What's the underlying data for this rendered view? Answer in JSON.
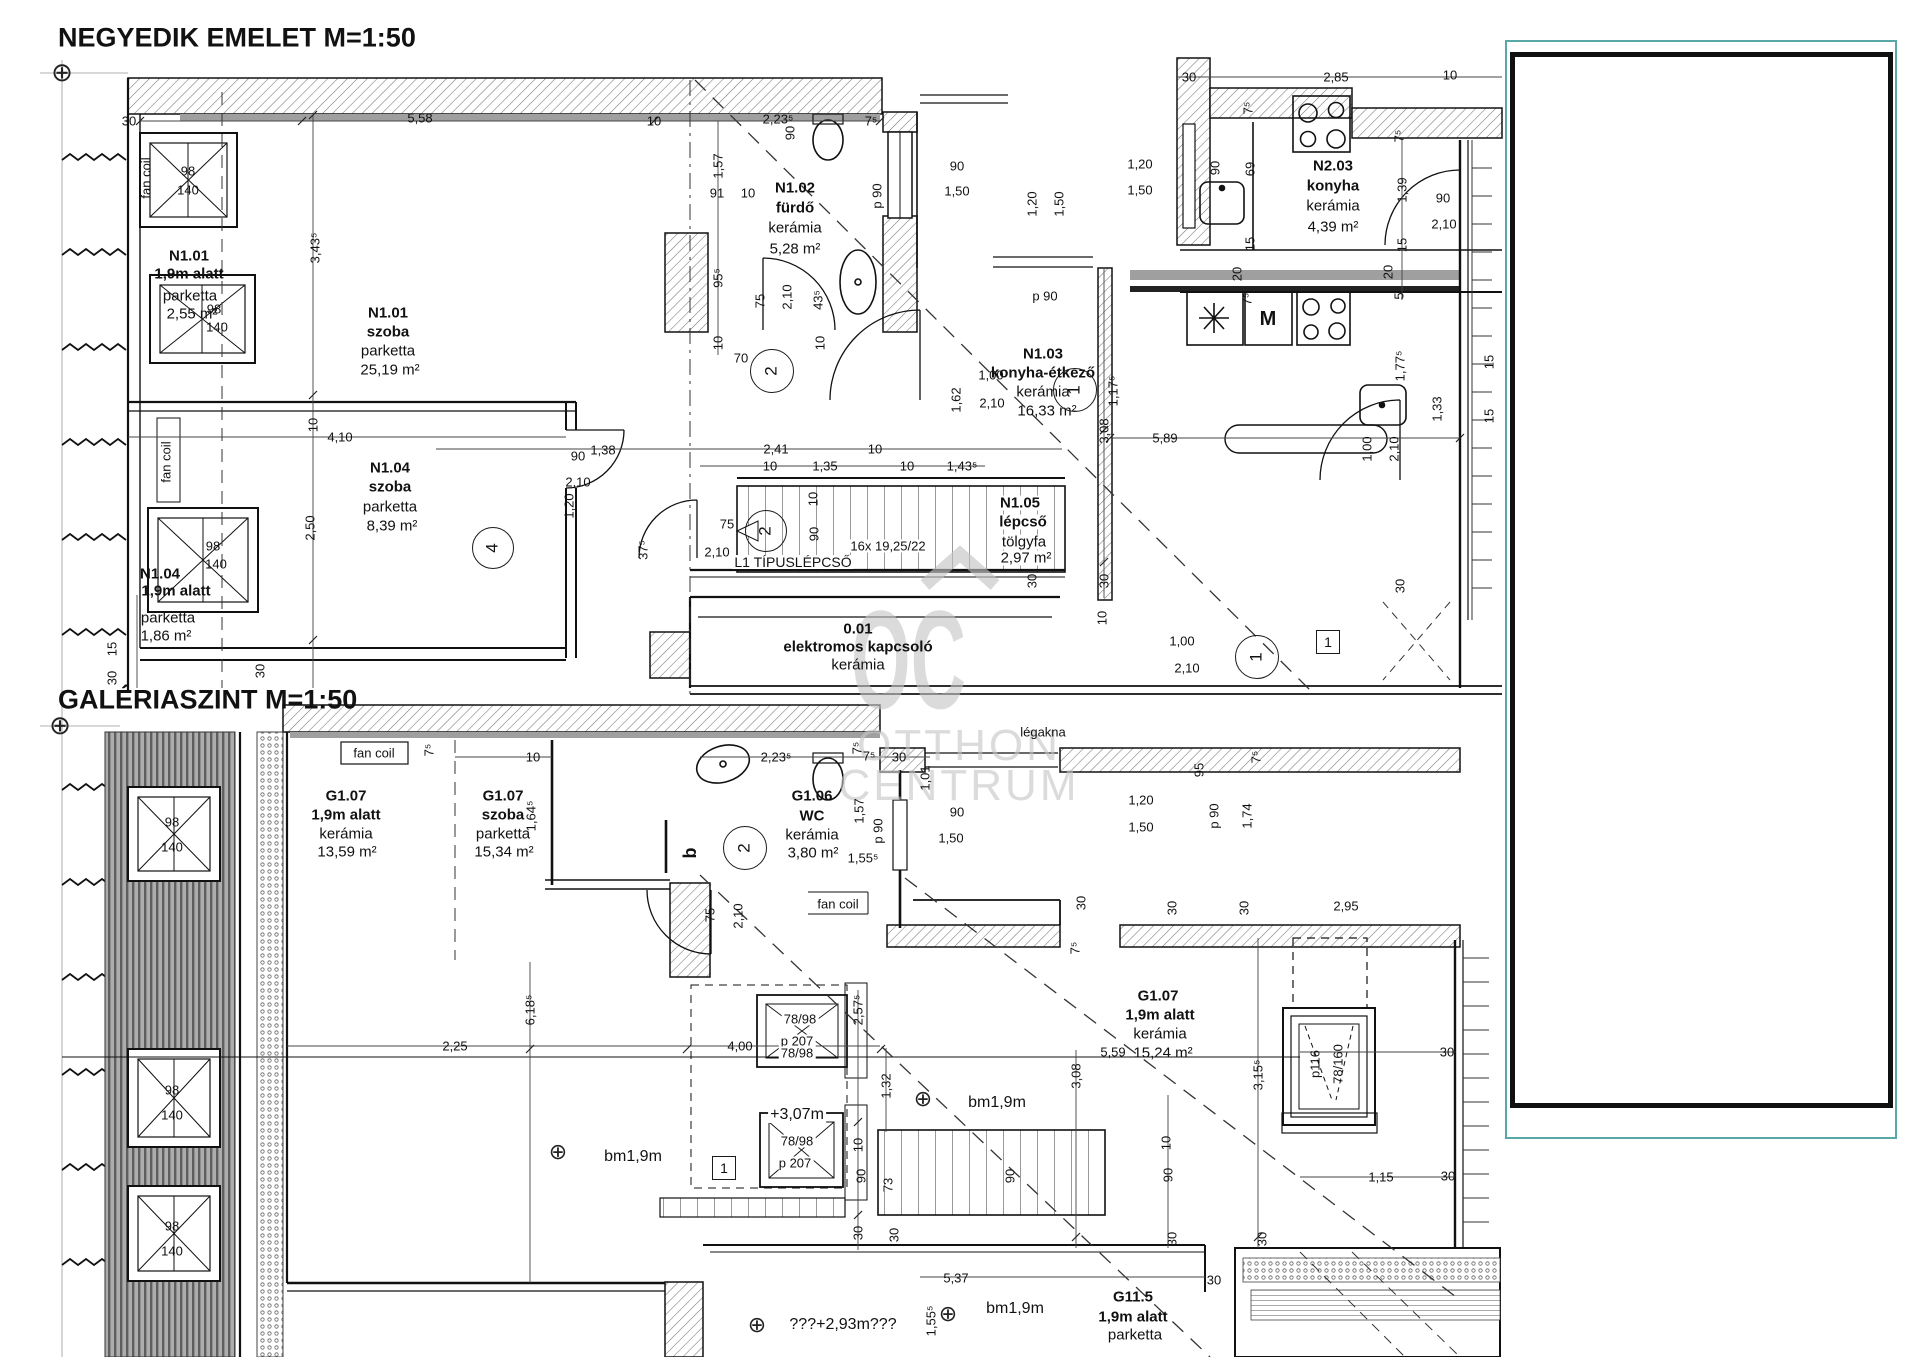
{
  "page": {
    "width": 1920,
    "height": 1357,
    "background": "#ffffff"
  },
  "colors": {
    "line": "#111111",
    "dim": "#444444",
    "watermark": "#c8c8c8",
    "panel_border_teal": "#58a8a8",
    "panel_border_black": "#101010",
    "roof_band": "#adadad"
  },
  "watermark": {
    "mark": "OC",
    "line1": "OTTHON",
    "line2": "CENTRUM"
  },
  "titles": {
    "upper": "NEGYEDIK EMELET M=1:50",
    "lower": "GALÉRIASZINT M=1:50"
  },
  "labels": [
    {
      "t": "NEGYEDIK EMELET M=1:50",
      "x": 58,
      "y": 38,
      "s": 27,
      "b": 1,
      "a": "l"
    },
    {
      "t": "GALÉRIASZINT M=1:50",
      "x": 58,
      "y": 700,
      "s": 27,
      "b": 1,
      "a": "l"
    },
    {
      "t": "30",
      "x": 129,
      "y": 121
    },
    {
      "t": "5,58",
      "x": 420,
      "y": 118
    },
    {
      "t": "10",
      "x": 654,
      "y": 121
    },
    {
      "t": "2,23⁵",
      "x": 778,
      "y": 119
    },
    {
      "t": "90",
      "x": 790,
      "y": 133,
      "r": 1
    },
    {
      "t": "7⁵",
      "x": 871,
      "y": 121
    },
    {
      "t": "1,57",
      "x": 718,
      "y": 166,
      "r": 1
    },
    {
      "t": "91",
      "x": 717,
      "y": 193
    },
    {
      "t": "10",
      "x": 748,
      "y": 193
    },
    {
      "t": "95⁵",
      "x": 718,
      "y": 278,
      "r": 1
    },
    {
      "t": "75",
      "x": 760,
      "y": 301,
      "r": 1
    },
    {
      "t": "2,10",
      "x": 787,
      "y": 297,
      "r": 1
    },
    {
      "t": "43⁵",
      "x": 818,
      "y": 300,
      "r": 1
    },
    {
      "t": "10",
      "x": 718,
      "y": 343,
      "r": 1
    },
    {
      "t": "10",
      "x": 820,
      "y": 343,
      "r": 1
    },
    {
      "t": "70",
      "x": 741,
      "y": 358
    },
    {
      "t": "p 90",
      "x": 877,
      "y": 196,
      "r": 1
    },
    {
      "t": "90",
      "x": 957,
      "y": 166
    },
    {
      "t": "1,50",
      "x": 957,
      "y": 191
    },
    {
      "t": "1,20",
      "x": 1140,
      "y": 164
    },
    {
      "t": "1,50",
      "x": 1140,
      "y": 190
    },
    {
      "t": "1,20",
      "x": 1032,
      "y": 204,
      "r": 1
    },
    {
      "t": "1,50",
      "x": 1059,
      "y": 204,
      "r": 1
    },
    {
      "t": "30",
      "x": 1189,
      "y": 77
    },
    {
      "t": "2,85",
      "x": 1336,
      "y": 77
    },
    {
      "t": "10",
      "x": 1450,
      "y": 75
    },
    {
      "t": "7⁵",
      "x": 1248,
      "y": 108,
      "r": 1
    },
    {
      "t": "7⁵",
      "x": 1399,
      "y": 136,
      "r": 1
    },
    {
      "t": "90",
      "x": 1215,
      "y": 168,
      "r": 1
    },
    {
      "t": "69",
      "x": 1250,
      "y": 169,
      "r": 1
    },
    {
      "t": "1,39",
      "x": 1402,
      "y": 190,
      "r": 1
    },
    {
      "t": "90",
      "x": 1443,
      "y": 198
    },
    {
      "t": "2,10",
      "x": 1444,
      "y": 224
    },
    {
      "t": "15",
      "x": 1250,
      "y": 244,
      "r": 1
    },
    {
      "t": "15",
      "x": 1402,
      "y": 245,
      "r": 1
    },
    {
      "t": "20",
      "x": 1237,
      "y": 274,
      "r": 1
    },
    {
      "t": "20",
      "x": 1388,
      "y": 272,
      "r": 1
    },
    {
      "t": "7⁵",
      "x": 1247,
      "y": 299,
      "r": 1
    },
    {
      "t": "5",
      "x": 1399,
      "y": 296,
      "r": 1
    },
    {
      "t": "M",
      "x": 1268,
      "y": 319,
      "b": 1,
      "s": 20
    },
    {
      "t": "1,77⁵",
      "x": 1400,
      "y": 366,
      "r": 1
    },
    {
      "t": "p 90",
      "x": 1045,
      "y": 296
    },
    {
      "t": "1,17⁵",
      "x": 1113,
      "y": 391,
      "r": 1
    },
    {
      "t": "1,00",
      "x": 991,
      "y": 375
    },
    {
      "t": "2,10",
      "x": 992,
      "y": 403
    },
    {
      "t": "1,62",
      "x": 956,
      "y": 400,
      "r": 1
    },
    {
      "t": "1,38",
      "x": 603,
      "y": 450
    },
    {
      "t": "2,41",
      "x": 776,
      "y": 449
    },
    {
      "t": "10",
      "x": 875,
      "y": 449
    },
    {
      "t": "10",
      "x": 770,
      "y": 466
    },
    {
      "t": "1,35",
      "x": 825,
      "y": 466
    },
    {
      "t": "10",
      "x": 907,
      "y": 466
    },
    {
      "t": "1,43⁵",
      "x": 962,
      "y": 466
    },
    {
      "t": "3,08",
      "x": 1104,
      "y": 431,
      "r": 1
    },
    {
      "t": "5,89",
      "x": 1165,
      "y": 438
    },
    {
      "t": "30",
      "x": 1104,
      "y": 581,
      "r": 1
    },
    {
      "t": "30",
      "x": 1032,
      "y": 581,
      "r": 1
    },
    {
      "t": "30",
      "x": 1400,
      "y": 586,
      "r": 1
    },
    {
      "t": "10",
      "x": 1102,
      "y": 618,
      "r": 1
    },
    {
      "t": "4,10",
      "x": 340,
      "y": 437
    },
    {
      "t": "10",
      "x": 313,
      "y": 425,
      "r": 1
    },
    {
      "t": "3,43⁵",
      "x": 315,
      "y": 248,
      "r": 1
    },
    {
      "t": "2,50",
      "x": 310,
      "y": 528,
      "r": 1
    },
    {
      "t": "15",
      "x": 112,
      "y": 649,
      "r": 1
    },
    {
      "t": "30",
      "x": 112,
      "y": 678,
      "r": 1
    },
    {
      "t": "30",
      "x": 260,
      "y": 671,
      "r": 1
    },
    {
      "t": "98",
      "x": 188,
      "y": 171
    },
    {
      "t": "140",
      "x": 188,
      "y": 190
    },
    {
      "t": "98",
      "x": 214,
      "y": 309
    },
    {
      "t": "140",
      "x": 217,
      "y": 327
    },
    {
      "t": "98",
      "x": 213,
      "y": 546
    },
    {
      "t": "140",
      "x": 216,
      "y": 564
    },
    {
      "t": "90",
      "x": 578,
      "y": 456
    },
    {
      "t": "2,10",
      "x": 578,
      "y": 482
    },
    {
      "t": "1,20",
      "x": 569,
      "y": 506,
      "r": 1
    },
    {
      "t": "75",
      "x": 727,
      "y": 524
    },
    {
      "t": "2,10",
      "x": 717,
      "y": 552
    },
    {
      "t": "37⁵",
      "x": 643,
      "y": 550,
      "r": 1
    },
    {
      "t": "10",
      "x": 813,
      "y": 499,
      "r": 1
    },
    {
      "t": "90",
      "x": 814,
      "y": 534,
      "r": 1
    },
    {
      "t": "16x 19,25/22",
      "x": 888,
      "y": 546,
      "bg": 1
    },
    {
      "t": "L1 TÍPUSLÉPCSŐ",
      "x": 793,
      "y": 562,
      "s": 14,
      "bg": 1
    },
    {
      "t": "1,00",
      "x": 1182,
      "y": 641
    },
    {
      "t": "2,10",
      "x": 1187,
      "y": 668
    },
    {
      "t": "1,00",
      "x": 1367,
      "y": 449,
      "r": 1
    },
    {
      "t": "2,10",
      "x": 1394,
      "y": 449,
      "r": 1
    },
    {
      "t": "1,33",
      "x": 1437,
      "y": 409,
      "r": 1
    },
    {
      "t": "15",
      "x": 1489,
      "y": 362,
      "r": 1
    },
    {
      "t": "15",
      "x": 1489,
      "y": 416,
      "r": 1
    },
    {
      "t": "N1.01",
      "x": 189,
      "y": 256,
      "b": 1,
      "s": 15
    },
    {
      "t": "1,9m alatt",
      "x": 189,
      "y": 274,
      "b": 1,
      "s": 15
    },
    {
      "t": "parketta",
      "x": 190,
      "y": 296,
      "s": 15
    },
    {
      "t": "2,55 m²",
      "x": 192,
      "y": 314,
      "s": 15
    },
    {
      "t": "N1.01",
      "x": 388,
      "y": 313,
      "b": 1,
      "s": 15
    },
    {
      "t": "szoba",
      "x": 388,
      "y": 332,
      "b": 1,
      "s": 15
    },
    {
      "t": "parketta",
      "x": 388,
      "y": 351,
      "s": 15
    },
    {
      "t": "25,19 m²",
      "x": 390,
      "y": 370,
      "s": 15
    },
    {
      "t": "N1.02",
      "x": 795,
      "y": 188,
      "b": 1,
      "s": 15
    },
    {
      "t": "fürdő",
      "x": 795,
      "y": 208,
      "b": 1,
      "s": 15
    },
    {
      "t": "kerámia",
      "x": 795,
      "y": 228,
      "s": 15
    },
    {
      "t": "5,28 m²",
      "x": 795,
      "y": 249,
      "s": 15
    },
    {
      "t": "N2.03",
      "x": 1333,
      "y": 166,
      "b": 1,
      "s": 15
    },
    {
      "t": "konyha",
      "x": 1333,
      "y": 186,
      "b": 1,
      "s": 15
    },
    {
      "t": "kerámia",
      "x": 1333,
      "y": 206,
      "s": 15
    },
    {
      "t": "4,39 m²",
      "x": 1333,
      "y": 227,
      "s": 15
    },
    {
      "t": "N1.03",
      "x": 1043,
      "y": 354,
      "b": 1,
      "s": 15
    },
    {
      "t": "konyha-étkező",
      "x": 1043,
      "y": 373,
      "b": 1,
      "s": 15
    },
    {
      "t": "kerámia",
      "x": 1043,
      "y": 392,
      "s": 15
    },
    {
      "t": "16,33 m²",
      "x": 1047,
      "y": 411,
      "s": 15
    },
    {
      "t": "N1.04",
      "x": 390,
      "y": 468,
      "b": 1,
      "s": 15
    },
    {
      "t": "szoba",
      "x": 390,
      "y": 487,
      "b": 1,
      "s": 15
    },
    {
      "t": "parketta",
      "x": 390,
      "y": 507,
      "s": 15
    },
    {
      "t": "8,39 m²",
      "x": 392,
      "y": 526,
      "s": 15
    },
    {
      "t": "N1.04",
      "x": 160,
      "y": 574,
      "b": 1,
      "s": 15
    },
    {
      "t": "1,9m alatt",
      "x": 176,
      "y": 591,
      "b": 1,
      "s": 15
    },
    {
      "t": "parketta",
      "x": 168,
      "y": 618,
      "s": 15
    },
    {
      "t": "1,86 m²",
      "x": 166,
      "y": 636,
      "s": 15
    },
    {
      "t": "N1.05",
      "x": 1020,
      "y": 503,
      "b": 1,
      "s": 15,
      "bg": 1
    },
    {
      "t": "lépcső",
      "x": 1023,
      "y": 522,
      "b": 1,
      "s": 15,
      "bg": 1
    },
    {
      "t": "tölgyfa",
      "x": 1024,
      "y": 542,
      "s": 15,
      "bg": 1
    },
    {
      "t": "2,97 m²",
      "x": 1026,
      "y": 558,
      "s": 15,
      "bg": 1
    },
    {
      "t": "0.01",
      "x": 858,
      "y": 629,
      "b": 1,
      "s": 15
    },
    {
      "t": "elektromos kapcsoló",
      "x": 858,
      "y": 647,
      "b": 1,
      "s": 15
    },
    {
      "t": "kerámia",
      "x": 858,
      "y": 665,
      "s": 15
    },
    {
      "t": "fan coil",
      "x": 146,
      "y": 178,
      "r": 1
    },
    {
      "t": "fan coil",
      "x": 166,
      "y": 462,
      "r": 1
    },
    {
      "t": "fan coil",
      "x": 374,
      "y": 753
    },
    {
      "t": "7⁵",
      "x": 429,
      "y": 750,
      "r": 1
    },
    {
      "t": "10",
      "x": 533,
      "y": 757
    },
    {
      "t": "G1.07",
      "x": 346,
      "y": 796,
      "b": 1,
      "s": 15
    },
    {
      "t": "1,9m alatt",
      "x": 346,
      "y": 815,
      "b": 1,
      "s": 15
    },
    {
      "t": "kerámia",
      "x": 346,
      "y": 834,
      "s": 15
    },
    {
      "t": "13,59 m²",
      "x": 347,
      "y": 852,
      "s": 15
    },
    {
      "t": "G1.07",
      "x": 503,
      "y": 796,
      "b": 1,
      "s": 15
    },
    {
      "t": "szoba",
      "x": 503,
      "y": 815,
      "b": 1,
      "s": 15
    },
    {
      "t": "parketta",
      "x": 503,
      "y": 834,
      "s": 15
    },
    {
      "t": "15,34 m²",
      "x": 504,
      "y": 852,
      "s": 15
    },
    {
      "t": "1,64⁵",
      "x": 531,
      "y": 816,
      "r": 1
    },
    {
      "t": "b",
      "x": 690,
      "y": 853,
      "b": 1,
      "s": 18,
      "r": 1
    },
    {
      "t": "G1.06",
      "x": 812,
      "y": 796,
      "b": 1,
      "s": 15
    },
    {
      "t": "WC",
      "x": 812,
      "y": 816,
      "b": 1,
      "s": 15
    },
    {
      "t": "kerámia",
      "x": 812,
      "y": 835,
      "s": 15
    },
    {
      "t": "3,80 m²",
      "x": 813,
      "y": 853,
      "s": 15
    },
    {
      "t": "2,23⁵",
      "x": 776,
      "y": 757
    },
    {
      "t": "7⁵",
      "x": 857,
      "y": 748,
      "r": 1
    },
    {
      "t": "7⁵",
      "x": 869,
      "y": 756
    },
    {
      "t": "30",
      "x": 899,
      "y": 757
    },
    {
      "t": "1,57",
      "x": 859,
      "y": 811,
      "r": 1
    },
    {
      "t": "p 90",
      "x": 878,
      "y": 831,
      "r": 1
    },
    {
      "t": "1,01",
      "x": 925,
      "y": 778,
      "r": 1
    },
    {
      "t": "90",
      "x": 957,
      "y": 812
    },
    {
      "t": "1,50",
      "x": 951,
      "y": 838
    },
    {
      "t": "légakna",
      "x": 1043,
      "y": 732
    },
    {
      "t": "1,55⁵",
      "x": 863,
      "y": 858
    },
    {
      "t": "75",
      "x": 710,
      "y": 915,
      "r": 1
    },
    {
      "t": "2,10",
      "x": 738,
      "y": 916,
      "r": 1
    },
    {
      "t": "fan coil",
      "x": 838,
      "y": 904
    },
    {
      "t": "95",
      "x": 1199,
      "y": 770,
      "r": 1
    },
    {
      "t": "7⁵",
      "x": 1256,
      "y": 757,
      "r": 1
    },
    {
      "t": "1,20",
      "x": 1141,
      "y": 800
    },
    {
      "t": "1,50",
      "x": 1141,
      "y": 827
    },
    {
      "t": "p 90",
      "x": 1214,
      "y": 816,
      "r": 1
    },
    {
      "t": "1,74",
      "x": 1247,
      "y": 816,
      "r": 1
    },
    {
      "t": "30",
      "x": 1081,
      "y": 903,
      "r": 1
    },
    {
      "t": "30",
      "x": 1172,
      "y": 908,
      "r": 1
    },
    {
      "t": "30",
      "x": 1244,
      "y": 908,
      "r": 1
    },
    {
      "t": "2,95",
      "x": 1346,
      "y": 906
    },
    {
      "t": "7⁵",
      "x": 1075,
      "y": 948,
      "r": 1
    },
    {
      "t": "G1.07",
      "x": 1158,
      "y": 996,
      "b": 1,
      "s": 15
    },
    {
      "t": "1,9m alatt",
      "x": 1160,
      "y": 1015,
      "b": 1,
      "s": 15
    },
    {
      "t": "kerámia",
      "x": 1160,
      "y": 1034,
      "s": 15
    },
    {
      "t": "15,24 m²",
      "x": 1163,
      "y": 1053,
      "s": 15
    },
    {
      "t": "5,59",
      "x": 1113,
      "y": 1052
    },
    {
      "t": "3,08",
      "x": 1076,
      "y": 1076,
      "r": 1
    },
    {
      "t": "3,15⁵",
      "x": 1258,
      "y": 1075,
      "r": 1
    },
    {
      "t": "p116",
      "x": 1315,
      "y": 1064,
      "r": 1
    },
    {
      "t": "78/160",
      "x": 1338,
      "y": 1064,
      "r": 1
    },
    {
      "t": "30",
      "x": 1447,
      "y": 1052
    },
    {
      "t": "1,15",
      "x": 1381,
      "y": 1177
    },
    {
      "t": "30",
      "x": 1448,
      "y": 1176
    },
    {
      "t": "10",
      "x": 1166,
      "y": 1143,
      "r": 1
    },
    {
      "t": "90",
      "x": 1168,
      "y": 1175,
      "r": 1
    },
    {
      "t": "6,18⁵",
      "x": 530,
      "y": 1010,
      "r": 1
    },
    {
      "t": "2,25",
      "x": 455,
      "y": 1046
    },
    {
      "t": "4,00",
      "x": 740,
      "y": 1046
    },
    {
      "t": "78/98",
      "x": 800,
      "y": 1019,
      "bg": 1
    },
    {
      "t": "p 207",
      "x": 797,
      "y": 1041,
      "bg": 1
    },
    {
      "t": "78/98",
      "x": 797,
      "y": 1053,
      "bg": 1
    },
    {
      "t": "2,57⁵",
      "x": 858,
      "y": 1010,
      "r": 1
    },
    {
      "t": "1,32",
      "x": 886,
      "y": 1086,
      "r": 1
    },
    {
      "t": "+3,07m",
      "x": 797,
      "y": 1115,
      "s": 16,
      "bg": 1
    },
    {
      "t": "78/98",
      "x": 797,
      "y": 1141,
      "bg": 1
    },
    {
      "t": "p 207",
      "x": 795,
      "y": 1163,
      "bg": 1
    },
    {
      "t": "bm1,9m",
      "x": 633,
      "y": 1157,
      "s": 16
    },
    {
      "t": "bm1,9m",
      "x": 997,
      "y": 1103,
      "s": 16
    },
    {
      "t": "10",
      "x": 858,
      "y": 1145,
      "r": 1
    },
    {
      "t": "90",
      "x": 861,
      "y": 1176,
      "r": 1
    },
    {
      "t": "73",
      "x": 888,
      "y": 1185,
      "r": 1
    },
    {
      "t": "90",
      "x": 1010,
      "y": 1176,
      "r": 1
    },
    {
      "t": "30",
      "x": 858,
      "y": 1233,
      "r": 1
    },
    {
      "t": "30",
      "x": 894,
      "y": 1235,
      "r": 1
    },
    {
      "t": "5,37",
      "x": 956,
      "y": 1278
    },
    {
      "t": "1,55⁵",
      "x": 931,
      "y": 1321,
      "r": 1
    },
    {
      "t": "bm1,9m",
      "x": 1015,
      "y": 1309,
      "s": 16
    },
    {
      "t": "???+2,93m???",
      "x": 843,
      "y": 1325,
      "s": 16
    },
    {
      "t": "G11.5",
      "x": 1133,
      "y": 1297,
      "b": 1,
      "s": 15
    },
    {
      "t": "1,9m alatt",
      "x": 1133,
      "y": 1317,
      "b": 1,
      "s": 15
    },
    {
      "t": "parketta",
      "x": 1135,
      "y": 1335,
      "s": 15
    },
    {
      "t": "30",
      "x": 1214,
      "y": 1280
    },
    {
      "t": "30",
      "x": 1172,
      "y": 1239,
      "r": 1
    },
    {
      "t": "30",
      "x": 1262,
      "y": 1239,
      "r": 1
    },
    {
      "t": "98",
      "x": 172,
      "y": 822
    },
    {
      "t": "140",
      "x": 172,
      "y": 847
    },
    {
      "t": "98",
      "x": 172,
      "y": 1090
    },
    {
      "t": "140",
      "x": 172,
      "y": 1115
    },
    {
      "t": "98",
      "x": 172,
      "y": 1226
    },
    {
      "t": "140",
      "x": 172,
      "y": 1251
    }
  ],
  "markers": [
    {
      "type": "circle",
      "n": "2",
      "x": 772,
      "y": 371,
      "d": 42
    },
    {
      "type": "circle",
      "n": "1",
      "x": 1075,
      "y": 390,
      "d": 42
    },
    {
      "type": "circle",
      "n": "4",
      "x": 493,
      "y": 548,
      "d": 40
    },
    {
      "type": "circle",
      "n": "2",
      "x": 766,
      "y": 531,
      "d": 40
    },
    {
      "type": "circle",
      "n": "1",
      "x": 1257,
      "y": 657,
      "d": 42
    },
    {
      "type": "circle",
      "n": "2",
      "x": 745,
      "y": 848,
      "d": 42
    },
    {
      "type": "flag",
      "n": "1",
      "x": 1328,
      "y": 642,
      "d": 22
    },
    {
      "type": "flag",
      "n": "1",
      "x": 724,
      "y": 1168,
      "d": 22
    },
    {
      "type": "target",
      "x": 558,
      "y": 1153,
      "d": 22
    },
    {
      "type": "target",
      "x": 923,
      "y": 1100,
      "d": 22
    },
    {
      "type": "target",
      "x": 948,
      "y": 1315,
      "d": 22
    },
    {
      "type": "target",
      "x": 757,
      "y": 1326,
      "d": 22
    },
    {
      "type": "target",
      "x": 62,
      "y": 73,
      "d": 26
    },
    {
      "type": "target",
      "x": 60,
      "y": 726,
      "d": 26
    }
  ]
}
